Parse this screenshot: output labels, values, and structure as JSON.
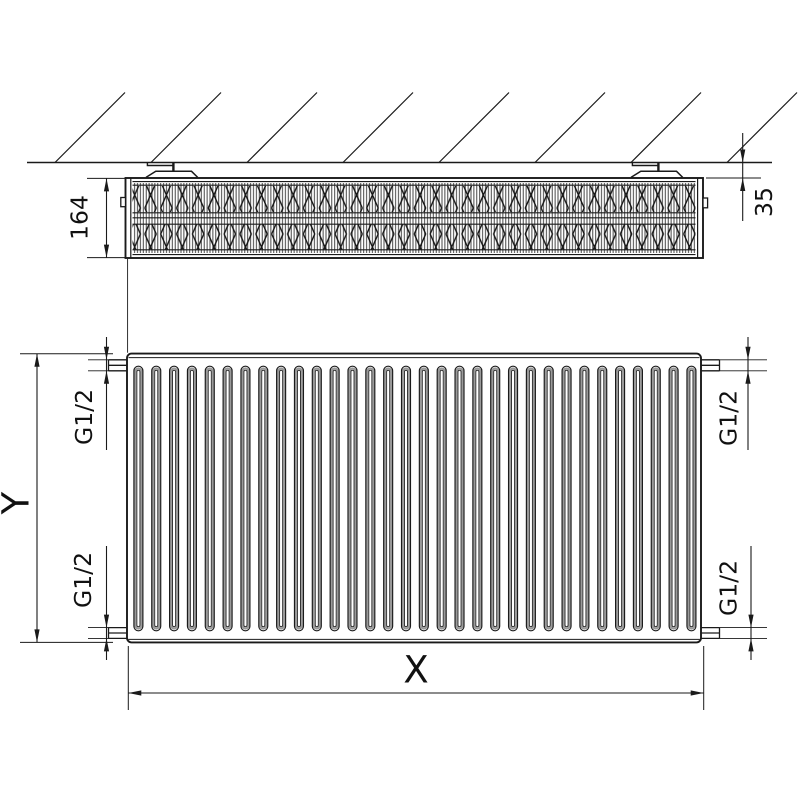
{
  "labels": {
    "depth": "164",
    "wall_clearance": "35",
    "height_axis": "Y",
    "width_axis": "X",
    "conn_top_left": "G1/2",
    "conn_bottom_left": "G1/2",
    "conn_top_right": "G1/2",
    "conn_bottom_right": "G1/2"
  },
  "colors": {
    "line": "#1a1a1a",
    "groove_shade": "#9a9a9a",
    "fin_texture": "#161616",
    "background": "#ffffff"
  }
}
